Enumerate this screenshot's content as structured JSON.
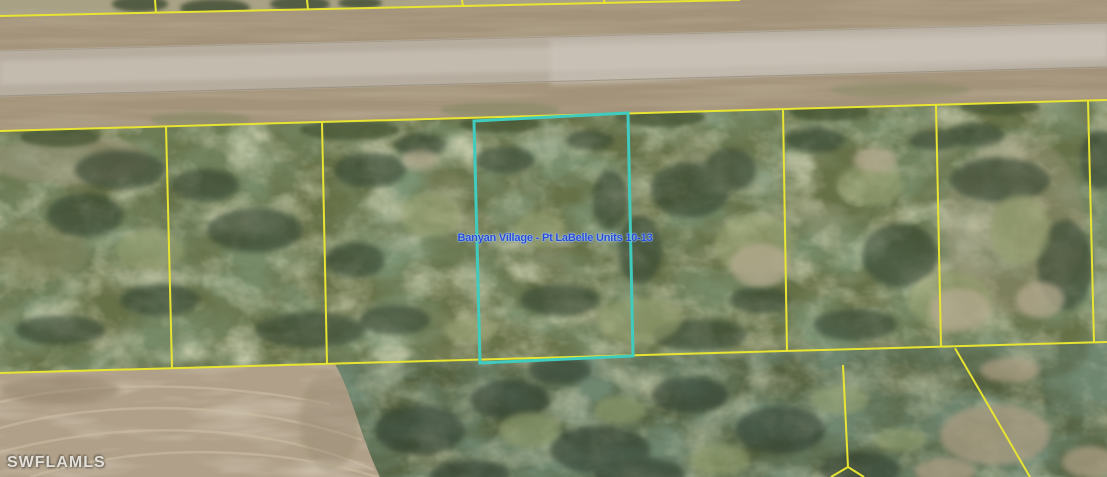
{
  "map": {
    "parcel_label": "Banyan Village - Pt LaBelle Units 10-13",
    "watermark": "SWFLAMLS"
  },
  "colors": {
    "parcel_line": "#e8e432",
    "highlight": "#3fccbe",
    "label_text": "#2b49d8",
    "watermark_text": "#edebe6"
  }
}
